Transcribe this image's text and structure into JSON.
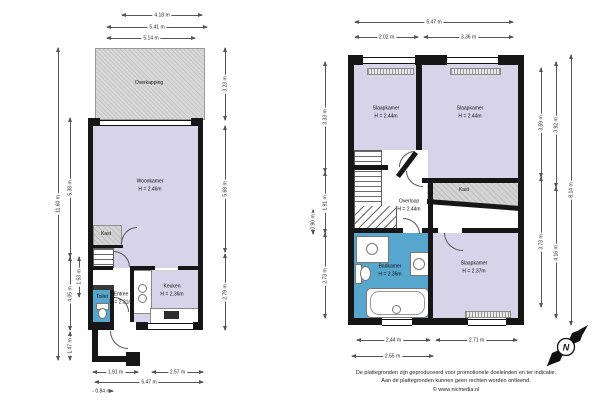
{
  "colors": {
    "room_fill": "#d7d3e8",
    "wet_room_fill": "#57a6ce",
    "storage_fill": "#cccccc",
    "wall": "#161616"
  },
  "ground_floor": {
    "rooms": {
      "overkapping": {
        "name": "Overkapping"
      },
      "woonkamer": {
        "name": "Woonkamer",
        "height": "H = 2.46m"
      },
      "kast": {
        "name": "Kast"
      },
      "keuken": {
        "name": "Keuken",
        "height": "H = 2.36m"
      },
      "entree": {
        "name": "Entree",
        "height": "H = 2.31m"
      },
      "toilet": {
        "name": "Toilet"
      }
    },
    "dims": {
      "top1": "4.18 m",
      "top2": "5.41 m",
      "top3": "5.14 m",
      "left_total": "11.60 m",
      "left_a": "5.38 m",
      "left_b": "4.05 m",
      "left_c": "1.53 m",
      "left_porch": "1.47 m",
      "right_a": "3.23 m",
      "right_b": "5.68 m",
      "right_c": "2.79 m",
      "bottom_a": "1.91 m",
      "bottom_b": "2.57 m",
      "bottom_total": "5.47 m",
      "bottom_c": "0.84 m"
    }
  },
  "upper_floor": {
    "rooms": {
      "slaapkamer_1": {
        "name": "Slaapkamer",
        "height": "H = 2.44m"
      },
      "slaapkamer_2": {
        "name": "Slaapkamer",
        "height": "H = 2.44m"
      },
      "overloop": {
        "name": "Overloop",
        "height": "H = 2.44m"
      },
      "kast": {
        "name": "Kast"
      },
      "badkamer": {
        "name": "Badkamer",
        "height": "H = 2.36m"
      },
      "slaapkamer_3": {
        "name": "Slaapkamer",
        "height": "H = 2.37m"
      }
    },
    "dims": {
      "top_total": "5.47 m",
      "top_a": "2.02 m",
      "top_b": "3.36 m",
      "left_a": "3.33 m",
      "left_b": "1.91 m",
      "left_small": "0.90 m",
      "left_c": "2.73 m",
      "right_a": "3.59 m",
      "right_b": "3.73 m",
      "right_c": "3.92 m",
      "right_d": "4.16 m",
      "right_total": "8.14 m",
      "bottom_a": "2.44 m",
      "bottom_b": "2.71 m",
      "bottom_c": "2.55 m"
    }
  },
  "footer": {
    "line1": "De plattegronden zijn geproduceerd voor promotionele doeleinden en ter indicatie.",
    "line2": "Aan de plattegronden kunnen geen rechten worden ontleend.",
    "line3": "© www.nicmedia.nl"
  },
  "compass": {
    "label": "N"
  }
}
